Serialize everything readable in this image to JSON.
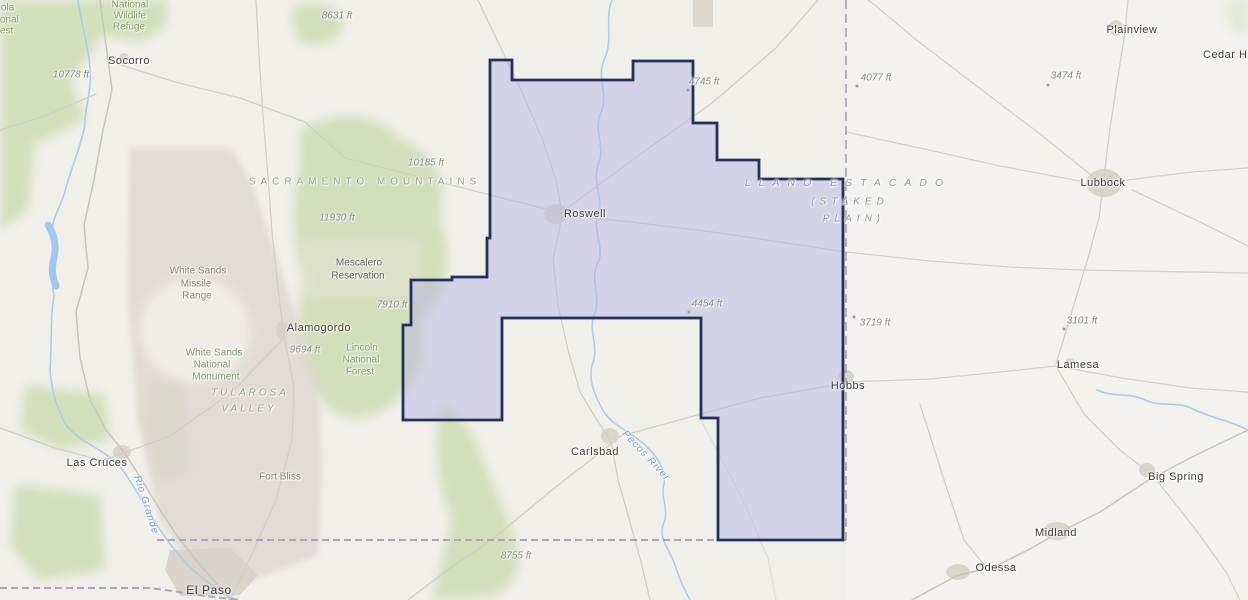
{
  "map": {
    "cities": {
      "socorro": "Socorro",
      "roswell": "Roswell",
      "carlsbad": "Carlsbad",
      "hobbs": "Hobbs",
      "alamogordo": "Alamogordo",
      "las_cruces": "Las Cruces",
      "el_paso": "El Paso",
      "lubbock": "Lubbock",
      "plainview": "Plainview",
      "lamesa": "Lamesa",
      "big_spring": "Big Spring",
      "midland": "Midland",
      "odessa": "Odessa",
      "cedar_h": "Cedar H"
    },
    "elevations": {
      "e10778": "10778 ft",
      "e8631": "8631 ft",
      "e10185": "10185 ft",
      "e11930": "11930 ft",
      "e7910": "7910 ft",
      "e9694": "9694 ft",
      "e4745": "4745 ft",
      "e4454": "4454 ft",
      "e4077": "4077 ft",
      "e3474": "3474 ft",
      "e3719": "3719 ft",
      "e3101": "3101 ft",
      "e8755": "8755 ft"
    },
    "physiographic": {
      "sacramento": "SACRAMENTO MOUNTAINS",
      "llano_line1": "LLANO ESTACADO",
      "llano_line2": "(STAKED",
      "llano_line3": "PLAIN)",
      "tularosa_line1": "TULAROSA",
      "tularosa_line2": "VALLEY"
    },
    "areas": {
      "wsmr_line1": "White Sands",
      "wsmr_line2": "Missile",
      "wsmr_line3": "Range",
      "fort_bliss": "Fort Bliss",
      "mescalero_line1": "Mescalero",
      "mescalero_line2": "Reservation",
      "wsnm_line1": "White Sands",
      "wsnm_line2": "National",
      "wsnm_line3": "Monument",
      "lincoln_line1": "Lincoln",
      "lincoln_line2": "National",
      "lincoln_line3": "Forest",
      "nwr_line1": "National",
      "nwr_line2": "Wildlife",
      "nwr_line3": "Refuge",
      "cibola_frag1": "ola",
      "cibola_frag2": "onal",
      "cibola_frag3": "est"
    },
    "rivers": {
      "rio_grande": "Rio Grande",
      "pecos": "Pecos River"
    },
    "colors": {
      "highlight_fill": "#b7b5e2",
      "highlight_stroke": "#22315a",
      "water": "#abcce9",
      "state_border_dash": "#a59db3",
      "south_border_dash": "#b2a0c2",
      "forest_green": "#c8d9ab",
      "military_tan": "#dcd7ce",
      "background": "#f1efea"
    }
  }
}
